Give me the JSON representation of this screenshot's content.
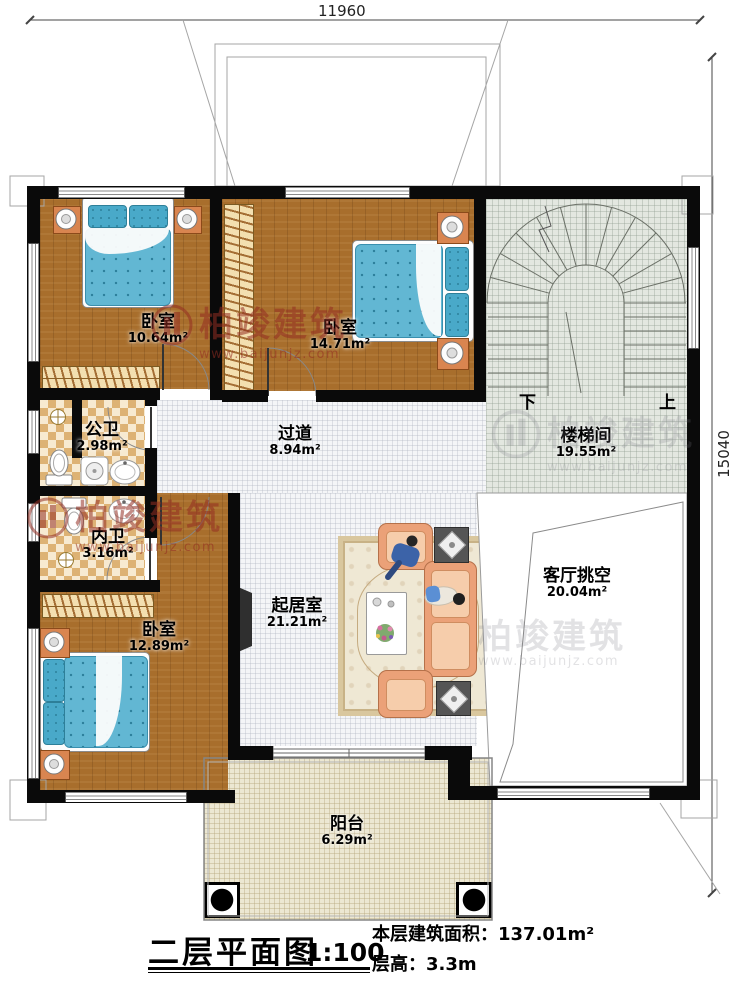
{
  "plan": {
    "title": "二层平面图",
    "scale": "1:100",
    "floor_area_label": "本层建筑面积：",
    "floor_area_value": "137.01m²",
    "floor_height_label": "层高：",
    "floor_height_value": "3.3m"
  },
  "dimensions": {
    "width_mm": "11960",
    "height_mm": "15040"
  },
  "stairs": {
    "down_label": "下",
    "up_label": "上"
  },
  "rooms": [
    {
      "id": "bedroom-top-left",
      "name": "卧室",
      "area": "10.64m²"
    },
    {
      "id": "bedroom-top-middle",
      "name": "卧室",
      "area": "14.71m²"
    },
    {
      "id": "stair-hall",
      "name": "楼梯间",
      "area": "19.55m²"
    },
    {
      "id": "hallway",
      "name": "过道",
      "area": "8.94m²"
    },
    {
      "id": "public-bathroom",
      "name": "公卫",
      "area": "2.98m²"
    },
    {
      "id": "ensuite-bathroom",
      "name": "内卫",
      "area": "3.16m²"
    },
    {
      "id": "bedroom-bottom-left",
      "name": "卧室",
      "area": "12.89m²"
    },
    {
      "id": "living-room",
      "name": "起居室",
      "area": "21.21m²"
    },
    {
      "id": "living-void",
      "name": "客厅挑空",
      "area": "20.04m²"
    },
    {
      "id": "balcony",
      "name": "阳台",
      "area": "6.29m²"
    }
  ],
  "watermark": {
    "brand": "柏竣建筑",
    "url": "www.baijunjz.com"
  },
  "colors": {
    "wall": "#0a0a0a",
    "wood_floor": "#a86e2c",
    "bed_blue": "#62b7d3",
    "sofa_salmon": "#eba178",
    "bath_tile": "#ddb274",
    "watermark_red": "#942d23"
  }
}
